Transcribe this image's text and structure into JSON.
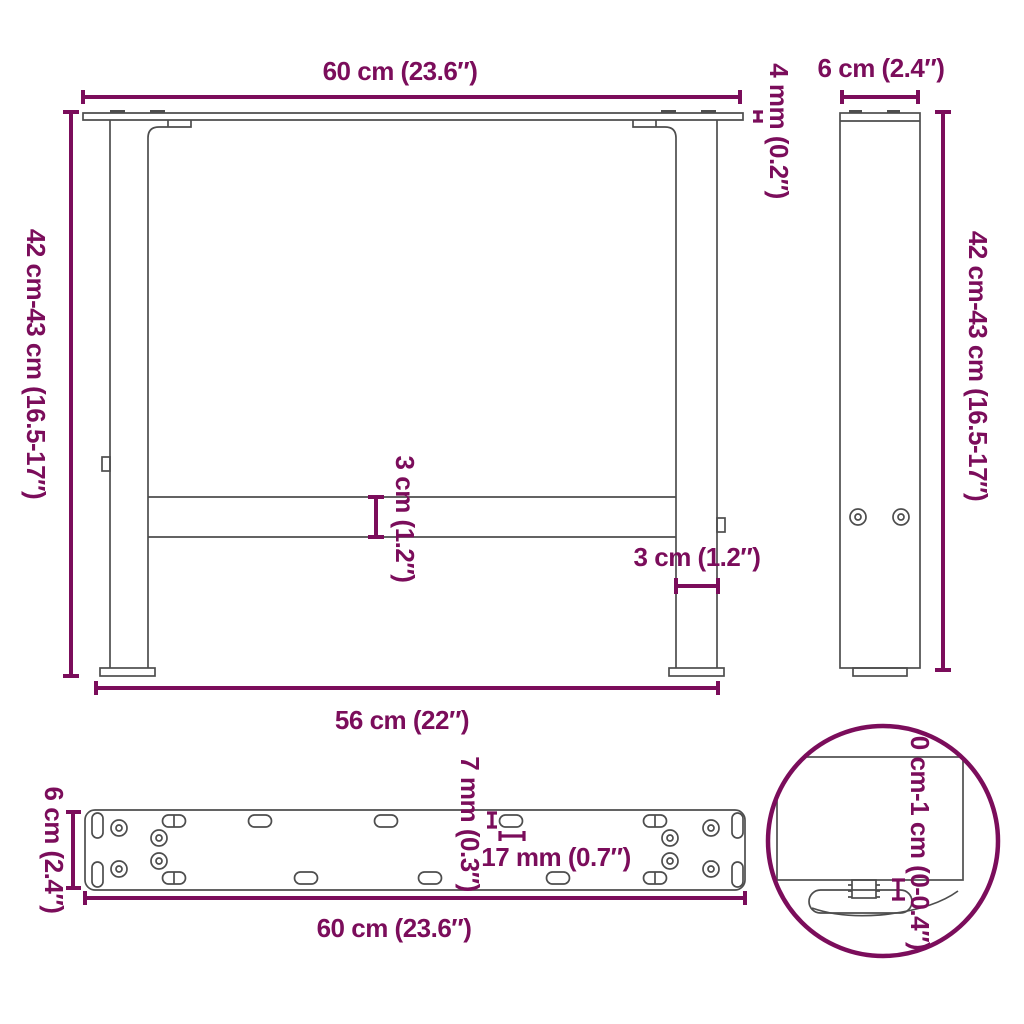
{
  "diagram_type": "furniture-dimension-drawing",
  "subject": "adjustable table legs",
  "accent_color": "#7b0d5b",
  "line_color": "#4d4d4d",
  "views": {
    "front": {
      "top_width": "60 cm (23.6″)",
      "plate_thickness": "4 mm (0.2″)",
      "height": "42 cm-43 cm (16.5-17″)",
      "crossbar_height": "3 cm (1.2″)",
      "leg_width": "3 cm (1.2″)",
      "base_width": "56 cm (22″)"
    },
    "side": {
      "depth": "6 cm (2.4″)",
      "height": "42 cm-43 cm (16.5-17″)"
    },
    "mounting_plate_top": {
      "depth": "6 cm (2.4″)",
      "width": "60 cm (23.6″)",
      "hole_diameter": "7 mm (0.3″)",
      "hole_spacing": "17 mm (0.7″)"
    },
    "foot_detail": {
      "adjustment_range": "0 cm-1 cm (0-0.4″)"
    }
  }
}
